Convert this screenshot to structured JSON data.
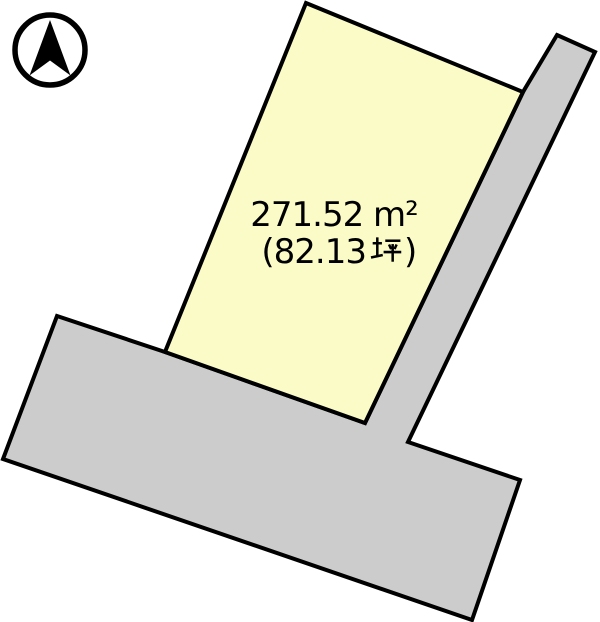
{
  "page": {
    "background_color": "#FFFFFF",
    "outline_color": "#000000"
  },
  "compass": {
    "icon": "north-arrow-compass",
    "ring_color": "#000000",
    "needle_color": "#000000"
  },
  "parcel": {
    "area_sqm_label": "271.52 m²",
    "area_sqm_value": 271.52,
    "area_tsubo_value": 82.13,
    "area_tsubo_prefix": "(82.13",
    "area_tsubo_unit": "坪",
    "area_tsubo_suffix": ")",
    "fill_color": "#FBFBC8"
  },
  "roads": {
    "fill_color": "#CCCCCC"
  }
}
